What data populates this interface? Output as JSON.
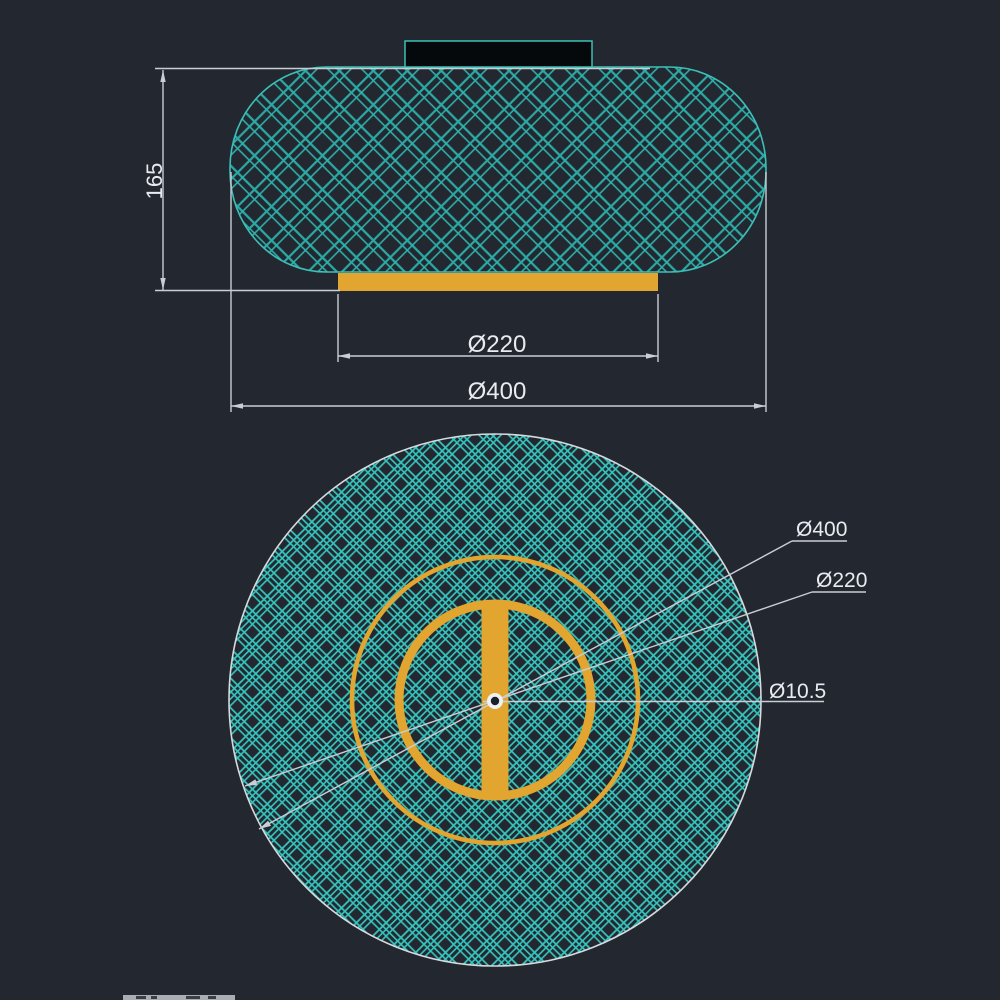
{
  "colors": {
    "background": "#232830",
    "hatch_top": "#2ba9a4",
    "hatch_top_light": "#2fb5af",
    "hatch_bottom": "#36c5be",
    "outline_teal": "#3cbfb8",
    "accent_yellow": "#e2a52f",
    "dim_line": "#c9ced6",
    "dim_text": "#e8ebf0",
    "mount_fill": "#06090b",
    "circle_outline": "#d6dadd",
    "center_dot": "#eef1f3",
    "hole_fill": "#1c2129",
    "watermark": "#a9aeb4",
    "watermark_marks": "#3a3f46"
  },
  "top_view": {
    "height_dim_label": "165",
    "inner_dim_label": "Ø220",
    "outer_dim_label": "Ø400"
  },
  "bottom_view": {
    "outer_label": "Ø400",
    "inner_label": "Ø220",
    "hole_label": "Ø10.5"
  }
}
